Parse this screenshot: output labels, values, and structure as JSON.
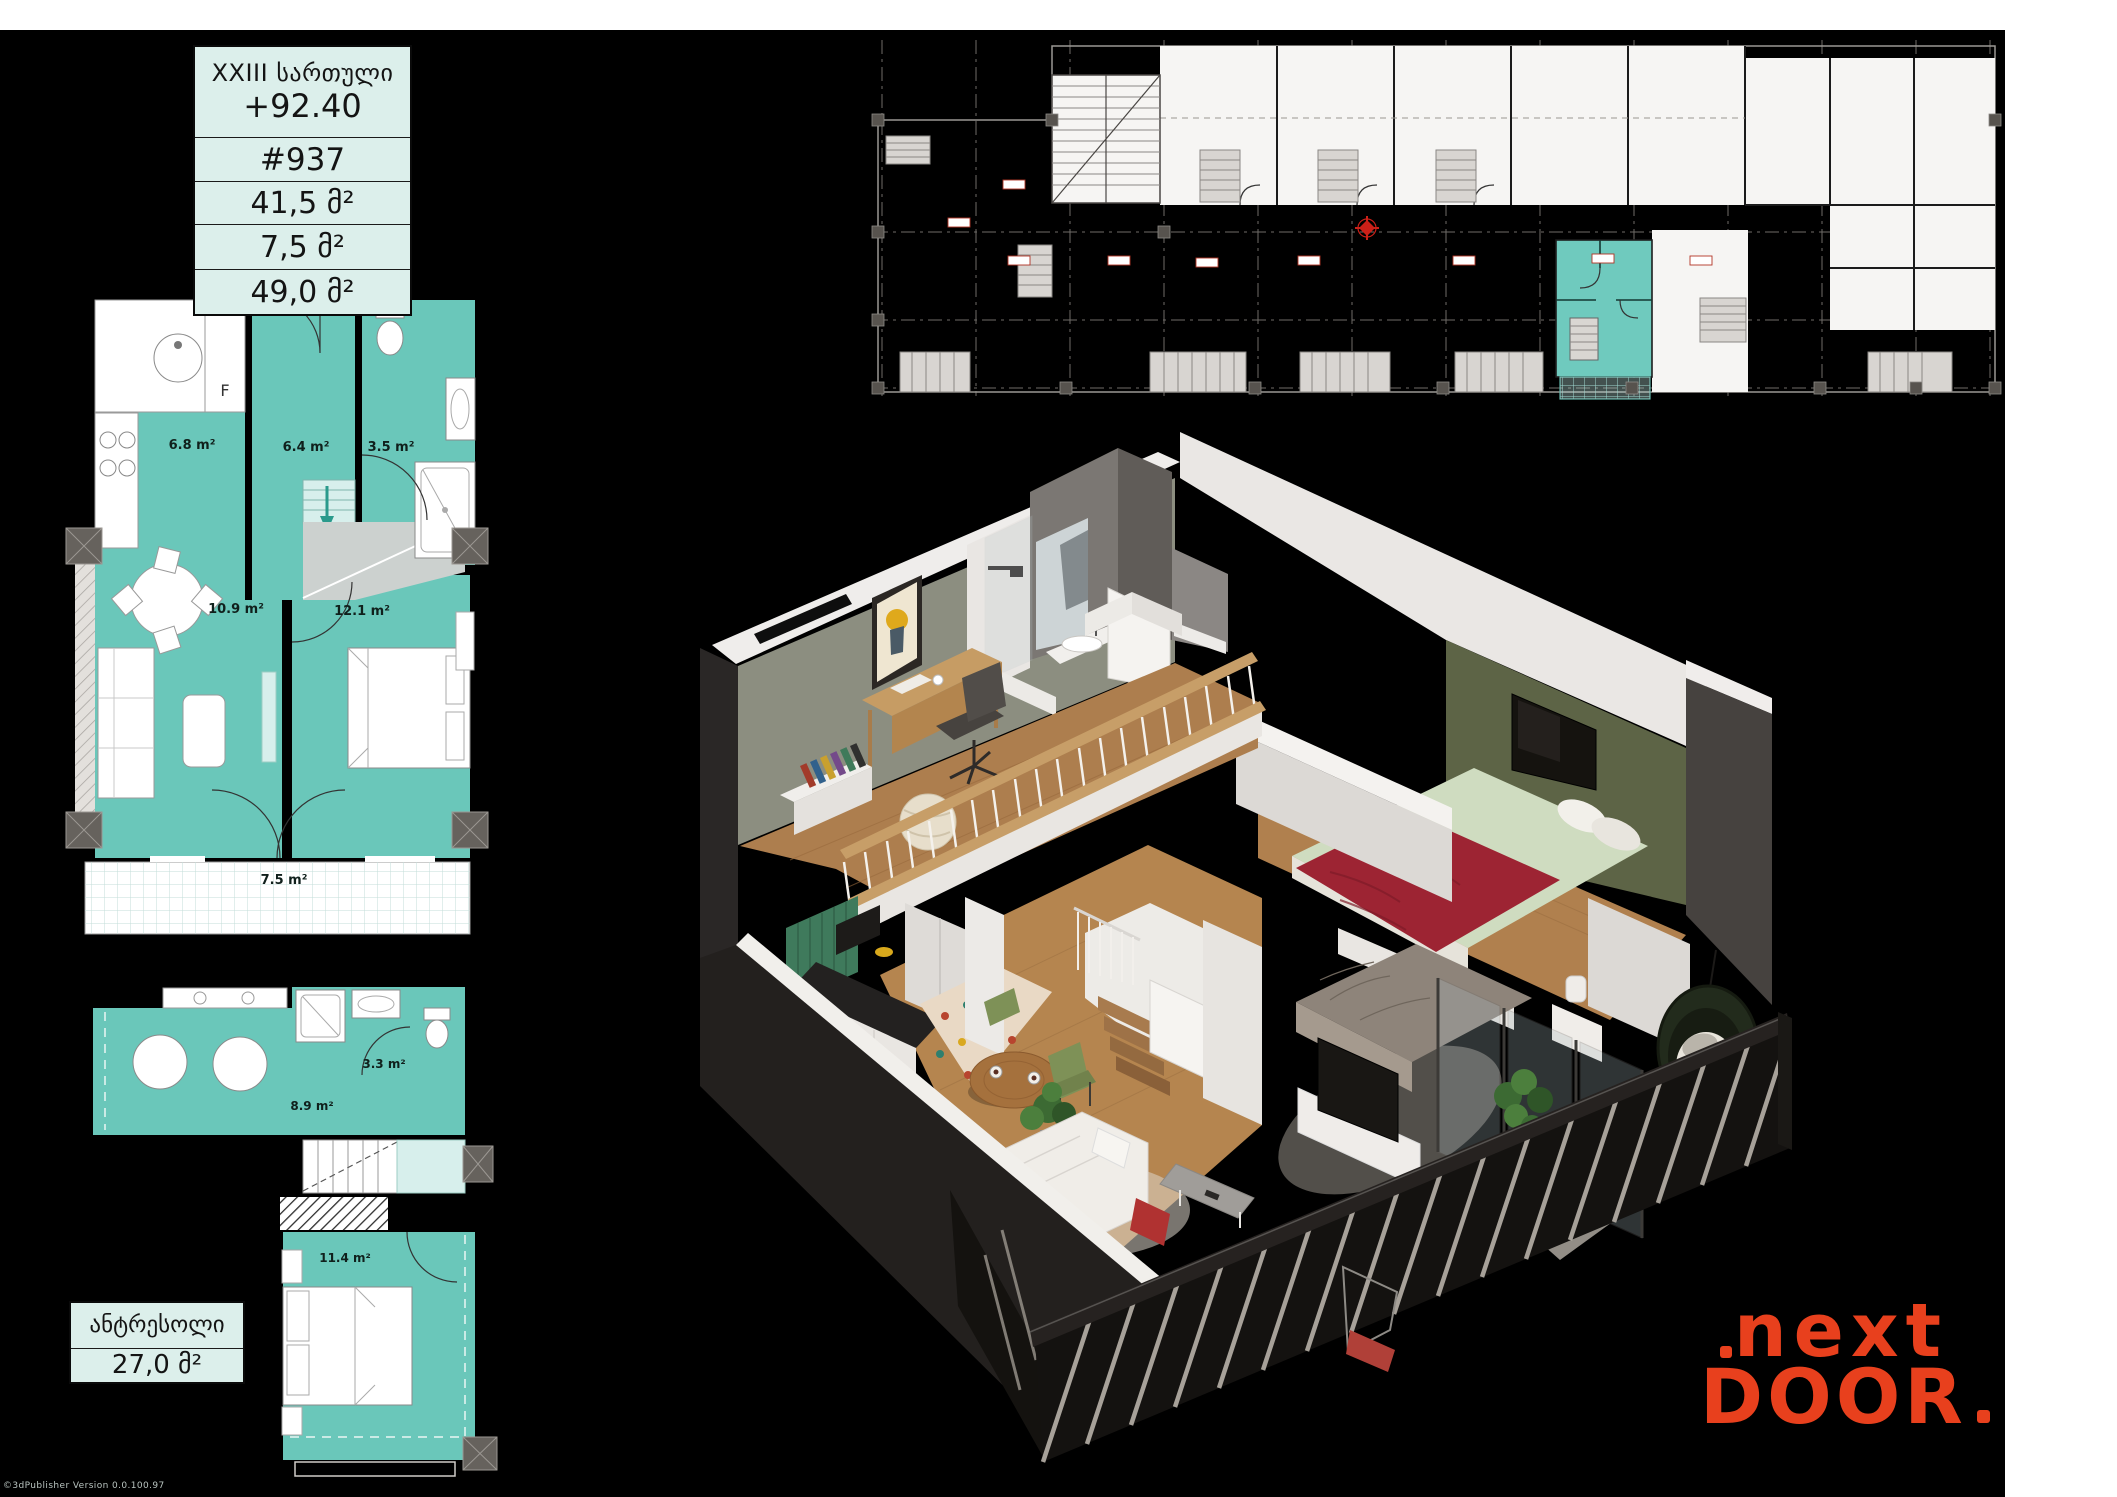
{
  "page": {
    "footer_note": "©3dPublisher Version 0.0.100.97"
  },
  "info_table": {
    "floor": "XXIII სართული",
    "elevation": "+92.40",
    "unit": "#937",
    "area_apartment": "41,5 მ²",
    "area_balcony": "7,5 მ²",
    "area_total": "49,0 მ²"
  },
  "main_plan": {
    "kitchen": "6.8 m²",
    "hall": "6.4 m²",
    "bathroom": "3.5 m²",
    "living": "10.9 m²",
    "bedroom": "12.1 m²",
    "balcony": "7.5 m²",
    "fridge": "F"
  },
  "mezzanine_plan": {
    "lounge": "8.9 m²",
    "bathroom": "3.3 m²",
    "bedroom": "11.4 m²"
  },
  "mezzanine_box": {
    "title": "ანტრესოლი",
    "area": "27,0 მ²"
  },
  "logo": {
    "line1": "next",
    "line2": "DOOR",
    "color": "#e8401d"
  },
  "colors": {
    "plan_teal": "#6ac7ba",
    "plan_light_teal": "#d7efec",
    "info_mint": "#dcefeb",
    "logo_orange": "#e8401d",
    "canvas_black": "#000000",
    "highlight_unit_teal": "#6fcabe"
  }
}
